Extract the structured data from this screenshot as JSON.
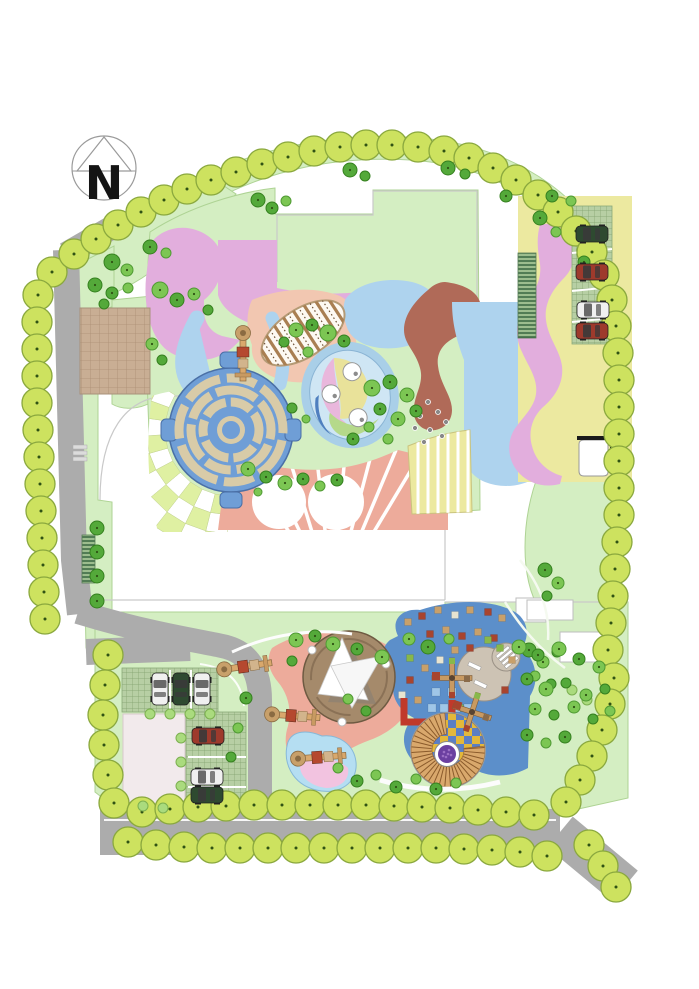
{
  "compass": {
    "label": "N"
  },
  "palette": {
    "boundary_tree_fill": "#cde25f",
    "boundary_tree_stroke": "#8aa83e",
    "tree_fill": "#7cc653",
    "tree_stroke": "#4f9a33",
    "tree_dark_fill": "#54a93a",
    "tree_dark_stroke": "#35801f",
    "tree_light_fill": "#aadb7e",
    "tree_light_stroke": "#7cb050",
    "lawn": "#d4eec2",
    "lawn_stroke": "#aed394",
    "road": "#acacac",
    "zone_pink": "#e2aedd",
    "zone_blue_light": "#aed3ee",
    "zone_blue_medium": "#6f9ed6",
    "zone_blue_play": "#5c8fca",
    "zone_salmon": "#edab9b",
    "zone_peach": "#f2c7b1",
    "zone_brown": "#b06a58",
    "zone_yellow": "#ece9a0",
    "checker_green": "#dff0a2",
    "plaza_tan": "#c9ae94",
    "maze_path": "#d8cba8",
    "grassgrid": "#b7cfa4",
    "canopy_base": "#a58a6b",
    "spiral_step": "#d9a86c",
    "checker_yellow": "#e3b83a",
    "checker_blue": "#5b7fc4",
    "purple": "#6b3fa0",
    "red_wall": "#c0392b",
    "pond": "#b5def2",
    "pond_pink": "#f2c3e0",
    "bench_circle": "#cdc3b4",
    "car_dark_green": "#2e4a30",
    "car_dark_red": "#9e3a2c",
    "car_white": "#f0f0f0"
  },
  "features": {
    "maze": {
      "cx": 231,
      "cy": 430,
      "outer_r": 62
    },
    "play_mound": {
      "cx": 448,
      "cy": 750,
      "r": 37
    },
    "canopy": {
      "cx": 349,
      "cy": 677,
      "r": 46
    },
    "bench_circle": {
      "cx": 484,
      "cy": 674,
      "r": 27
    }
  },
  "boundary_trees": [
    [
      52,
      272
    ],
    [
      74,
      254
    ],
    [
      96,
      239
    ],
    [
      118,
      225
    ],
    [
      141,
      212
    ],
    [
      164,
      200
    ],
    [
      187,
      189
    ],
    [
      211,
      180
    ],
    [
      236,
      172
    ],
    [
      262,
      164
    ],
    [
      288,
      157
    ],
    [
      314,
      151
    ],
    [
      340,
      147
    ],
    [
      366,
      145
    ],
    [
      392,
      145
    ],
    [
      418,
      147
    ],
    [
      444,
      151
    ],
    [
      469,
      158
    ],
    [
      493,
      168
    ],
    [
      516,
      180
    ],
    [
      538,
      195
    ],
    [
      558,
      212
    ],
    [
      576,
      231
    ],
    [
      592,
      252
    ],
    [
      604,
      275
    ],
    [
      612,
      300
    ],
    [
      616,
      326
    ],
    [
      618,
      353
    ],
    [
      619,
      380
    ],
    [
      619,
      407
    ],
    [
      619,
      434
    ],
    [
      619,
      461
    ],
    [
      619,
      488
    ],
    [
      619,
      515
    ],
    [
      617,
      542
    ],
    [
      615,
      569
    ],
    [
      613,
      596
    ],
    [
      611,
      623
    ],
    [
      608,
      650
    ],
    [
      614,
      678
    ],
    [
      610,
      704
    ],
    [
      602,
      730
    ],
    [
      592,
      756
    ],
    [
      580,
      780
    ],
    [
      566,
      802
    ],
    [
      38,
      295
    ],
    [
      37,
      322
    ],
    [
      37,
      349
    ],
    [
      37,
      376
    ],
    [
      37,
      403
    ],
    [
      38,
      430
    ],
    [
      39,
      457
    ],
    [
      40,
      484
    ],
    [
      41,
      511
    ],
    [
      42,
      538
    ],
    [
      43,
      565
    ],
    [
      44,
      592
    ],
    [
      45,
      619
    ],
    [
      108,
      655
    ],
    [
      105,
      685
    ],
    [
      103,
      715
    ],
    [
      104,
      745
    ],
    [
      108,
      775
    ],
    [
      114,
      803
    ],
    [
      142,
      812
    ],
    [
      170,
      809
    ],
    [
      198,
      807
    ],
    [
      226,
      806
    ],
    [
      254,
      805
    ],
    [
      282,
      805
    ],
    [
      310,
      805
    ],
    [
      338,
      805
    ],
    [
      366,
      805
    ],
    [
      394,
      806
    ],
    [
      422,
      807
    ],
    [
      450,
      808
    ],
    [
      478,
      810
    ],
    [
      506,
      812
    ],
    [
      534,
      815
    ],
    [
      128,
      842
    ],
    [
      156,
      845
    ],
    [
      184,
      847
    ],
    [
      212,
      848
    ],
    [
      240,
      848
    ],
    [
      268,
      848
    ],
    [
      296,
      848
    ],
    [
      324,
      848
    ],
    [
      352,
      848
    ],
    [
      380,
      848
    ],
    [
      408,
      848
    ],
    [
      436,
      848
    ],
    [
      464,
      849
    ],
    [
      492,
      850
    ],
    [
      520,
      852
    ],
    [
      547,
      856
    ],
    [
      589,
      845
    ],
    [
      603,
      866
    ],
    [
      616,
      887
    ]
  ],
  "scatter_trees": [
    [
      112,
      262,
      8,
      1
    ],
    [
      127,
      270,
      6,
      0
    ],
    [
      150,
      247,
      7,
      1
    ],
    [
      166,
      253,
      5,
      0
    ],
    [
      258,
      200,
      7,
      1
    ],
    [
      272,
      208,
      6,
      1
    ],
    [
      286,
      201,
      5,
      0
    ],
    [
      350,
      170,
      7,
      1
    ],
    [
      365,
      176,
      5,
      1
    ],
    [
      448,
      168,
      7,
      1
    ],
    [
      465,
      174,
      5,
      1
    ],
    [
      506,
      196,
      6,
      1
    ],
    [
      540,
      218,
      7,
      1
    ],
    [
      556,
      232,
      5,
      0
    ],
    [
      584,
      262,
      6,
      1
    ],
    [
      552,
      196,
      6,
      1
    ],
    [
      571,
      201,
      5,
      0
    ],
    [
      95,
      285,
      7,
      1
    ],
    [
      112,
      293,
      6,
      1
    ],
    [
      128,
      288,
      5,
      0
    ],
    [
      104,
      304,
      5,
      1
    ],
    [
      160,
      290,
      8,
      0
    ],
    [
      177,
      300,
      7,
      1
    ],
    [
      194,
      294,
      6,
      0
    ],
    [
      208,
      310,
      5,
      1
    ],
    [
      152,
      344,
      6,
      0
    ],
    [
      162,
      360,
      5,
      1
    ],
    [
      296,
      330,
      7,
      0
    ],
    [
      312,
      325,
      6,
      1
    ],
    [
      328,
      333,
      8,
      0
    ],
    [
      344,
      341,
      6,
      1
    ],
    [
      308,
      352,
      5,
      0
    ],
    [
      284,
      342,
      5,
      1
    ],
    [
      372,
      388,
      8,
      0
    ],
    [
      390,
      382,
      7,
      1
    ],
    [
      407,
      395,
      7,
      0
    ],
    [
      380,
      409,
      6,
      1
    ],
    [
      398,
      419,
      7,
      0
    ],
    [
      416,
      411,
      6,
      1
    ],
    [
      369,
      427,
      5,
      0
    ],
    [
      353,
      439,
      6,
      1
    ],
    [
      388,
      439,
      5,
      0
    ],
    [
      292,
      408,
      5,
      1
    ],
    [
      306,
      419,
      4,
      0
    ],
    [
      248,
      469,
      7,
      0
    ],
    [
      266,
      477,
      6,
      1
    ],
    [
      285,
      483,
      7,
      0
    ],
    [
      303,
      479,
      6,
      1
    ],
    [
      320,
      486,
      5,
      0
    ],
    [
      337,
      480,
      6,
      1
    ],
    [
      258,
      492,
      4,
      0
    ],
    [
      97,
      528,
      7,
      1
    ],
    [
      97,
      552,
      7,
      1
    ],
    [
      97,
      576,
      7,
      1
    ],
    [
      97,
      601,
      7,
      1
    ],
    [
      545,
      570,
      7,
      1
    ],
    [
      558,
      583,
      6,
      0
    ],
    [
      547,
      596,
      5,
      1
    ],
    [
      529,
      650,
      7,
      1
    ],
    [
      543,
      662,
      6,
      0
    ],
    [
      557,
      652,
      5,
      1
    ],
    [
      535,
      676,
      5,
      0
    ],
    [
      551,
      684,
      5,
      1
    ],
    [
      572,
      690,
      5,
      2
    ],
    [
      587,
      700,
      5,
      2
    ],
    [
      296,
      640,
      7,
      0
    ],
    [
      315,
      636,
      6,
      1
    ],
    [
      333,
      644,
      7,
      0
    ],
    [
      357,
      649,
      6,
      1
    ],
    [
      382,
      657,
      7,
      0
    ],
    [
      292,
      661,
      5,
      1
    ],
    [
      409,
      639,
      6,
      0
    ],
    [
      428,
      647,
      7,
      1
    ],
    [
      449,
      639,
      5,
      0
    ],
    [
      519,
      647,
      7,
      0
    ],
    [
      538,
      655,
      6,
      1
    ],
    [
      559,
      649,
      7,
      0
    ],
    [
      579,
      659,
      6,
      1
    ],
    [
      599,
      667,
      6,
      0
    ],
    [
      527,
      679,
      6,
      1
    ],
    [
      546,
      689,
      7,
      0
    ],
    [
      566,
      683,
      5,
      1
    ],
    [
      586,
      695,
      6,
      0
    ],
    [
      605,
      689,
      5,
      1
    ],
    [
      535,
      709,
      6,
      0
    ],
    [
      554,
      715,
      5,
      1
    ],
    [
      574,
      707,
      6,
      0
    ],
    [
      593,
      719,
      5,
      1
    ],
    [
      610,
      711,
      5,
      0
    ],
    [
      527,
      735,
      6,
      1
    ],
    [
      546,
      743,
      5,
      0
    ],
    [
      565,
      737,
      6,
      1
    ],
    [
      348,
      699,
      5,
      0
    ],
    [
      366,
      711,
      5,
      1
    ],
    [
      338,
      768,
      5,
      0
    ],
    [
      357,
      781,
      6,
      1
    ],
    [
      376,
      775,
      5,
      0
    ],
    [
      396,
      787,
      6,
      1
    ],
    [
      416,
      779,
      5,
      0
    ],
    [
      436,
      789,
      6,
      1
    ],
    [
      456,
      783,
      5,
      0
    ],
    [
      246,
      698,
      6,
      1
    ],
    [
      238,
      728,
      5,
      0
    ],
    [
      231,
      757,
      5,
      1
    ],
    [
      150,
      714,
      5,
      2
    ],
    [
      170,
      714,
      5,
      2
    ],
    [
      190,
      714,
      5,
      2
    ],
    [
      210,
      714,
      5,
      2
    ],
    [
      181,
      738,
      5,
      2
    ],
    [
      181,
      762,
      5,
      2
    ],
    [
      181,
      786,
      5,
      2
    ],
    [
      143,
      806,
      5,
      2
    ],
    [
      163,
      808,
      5,
      2
    ]
  ],
  "pebbles": [
    [
      428,
      402
    ],
    [
      438,
      412
    ],
    [
      420,
      416
    ],
    [
      446,
      422
    ],
    [
      430,
      430
    ],
    [
      415,
      428
    ],
    [
      442,
      436
    ],
    [
      424,
      442
    ]
  ],
  "confetti_colors": [
    "#c8a06a",
    "#a8442e",
    "#88b84a",
    "#e8e4d0",
    "#9fc6e8"
  ],
  "confetti": [
    [
      408,
      622,
      0
    ],
    [
      422,
      616,
      1
    ],
    [
      438,
      610,
      0
    ],
    [
      455,
      615,
      3
    ],
    [
      470,
      610,
      0
    ],
    [
      488,
      612,
      1
    ],
    [
      502,
      618,
      0
    ],
    [
      430,
      634,
      1
    ],
    [
      446,
      630,
      0
    ],
    [
      462,
      636,
      1
    ],
    [
      478,
      632,
      0
    ],
    [
      494,
      638,
      1
    ],
    [
      455,
      650,
      0
    ],
    [
      470,
      648,
      1
    ],
    [
      440,
      660,
      3
    ],
    [
      425,
      668,
      0
    ],
    [
      410,
      680,
      1
    ],
    [
      418,
      700,
      0
    ],
    [
      500,
      648,
      2
    ],
    [
      512,
      660,
      0
    ],
    [
      505,
      690,
      1
    ],
    [
      470,
      730,
      0
    ],
    [
      432,
      730,
      1
    ],
    [
      420,
      742,
      0
    ],
    [
      488,
      640,
      2
    ],
    [
      410,
      658,
      2
    ],
    [
      402,
      695,
      3
    ],
    [
      460,
      708,
      2
    ],
    [
      432,
      708,
      4
    ],
    [
      444,
      708,
      4
    ],
    [
      456,
      708,
      4
    ],
    [
      468,
      708,
      4
    ],
    [
      436,
      692,
      4
    ],
    [
      452,
      692,
      4
    ]
  ],
  "cars": [
    {
      "x": 592,
      "y": 234,
      "a": 0,
      "c": "car_dark_green"
    },
    {
      "x": 592,
      "y": 272,
      "a": 0,
      "c": "car_dark_red"
    },
    {
      "x": 593,
      "y": 310,
      "a": 0,
      "c": "car_white"
    },
    {
      "x": 592,
      "y": 331,
      "a": 0,
      "c": "car_dark_red"
    },
    {
      "x": 160,
      "y": 689,
      "a": 90,
      "c": "car_white"
    },
    {
      "x": 181,
      "y": 689,
      "a": 90,
      "c": "car_dark_green"
    },
    {
      "x": 202,
      "y": 689,
      "a": 90,
      "c": "car_white"
    },
    {
      "x": 208,
      "y": 736,
      "a": 0,
      "c": "car_dark_red"
    },
    {
      "x": 207,
      "y": 777,
      "a": 0,
      "c": "car_white"
    },
    {
      "x": 207,
      "y": 795,
      "a": 0,
      "c": "car_dark_green"
    }
  ],
  "slides": [
    {
      "x": 248,
      "y": 666,
      "rot": -8
    },
    {
      "x": 296,
      "y": 716,
      "rot": 4
    },
    {
      "x": 322,
      "y": 757,
      "rot": -4
    },
    {
      "x": 243,
      "y": 357,
      "rot": 90
    }
  ],
  "crosses": [
    {
      "x": 452,
      "y": 678,
      "rot": 0
    },
    {
      "x": 472,
      "y": 712,
      "rot": 18
    }
  ]
}
